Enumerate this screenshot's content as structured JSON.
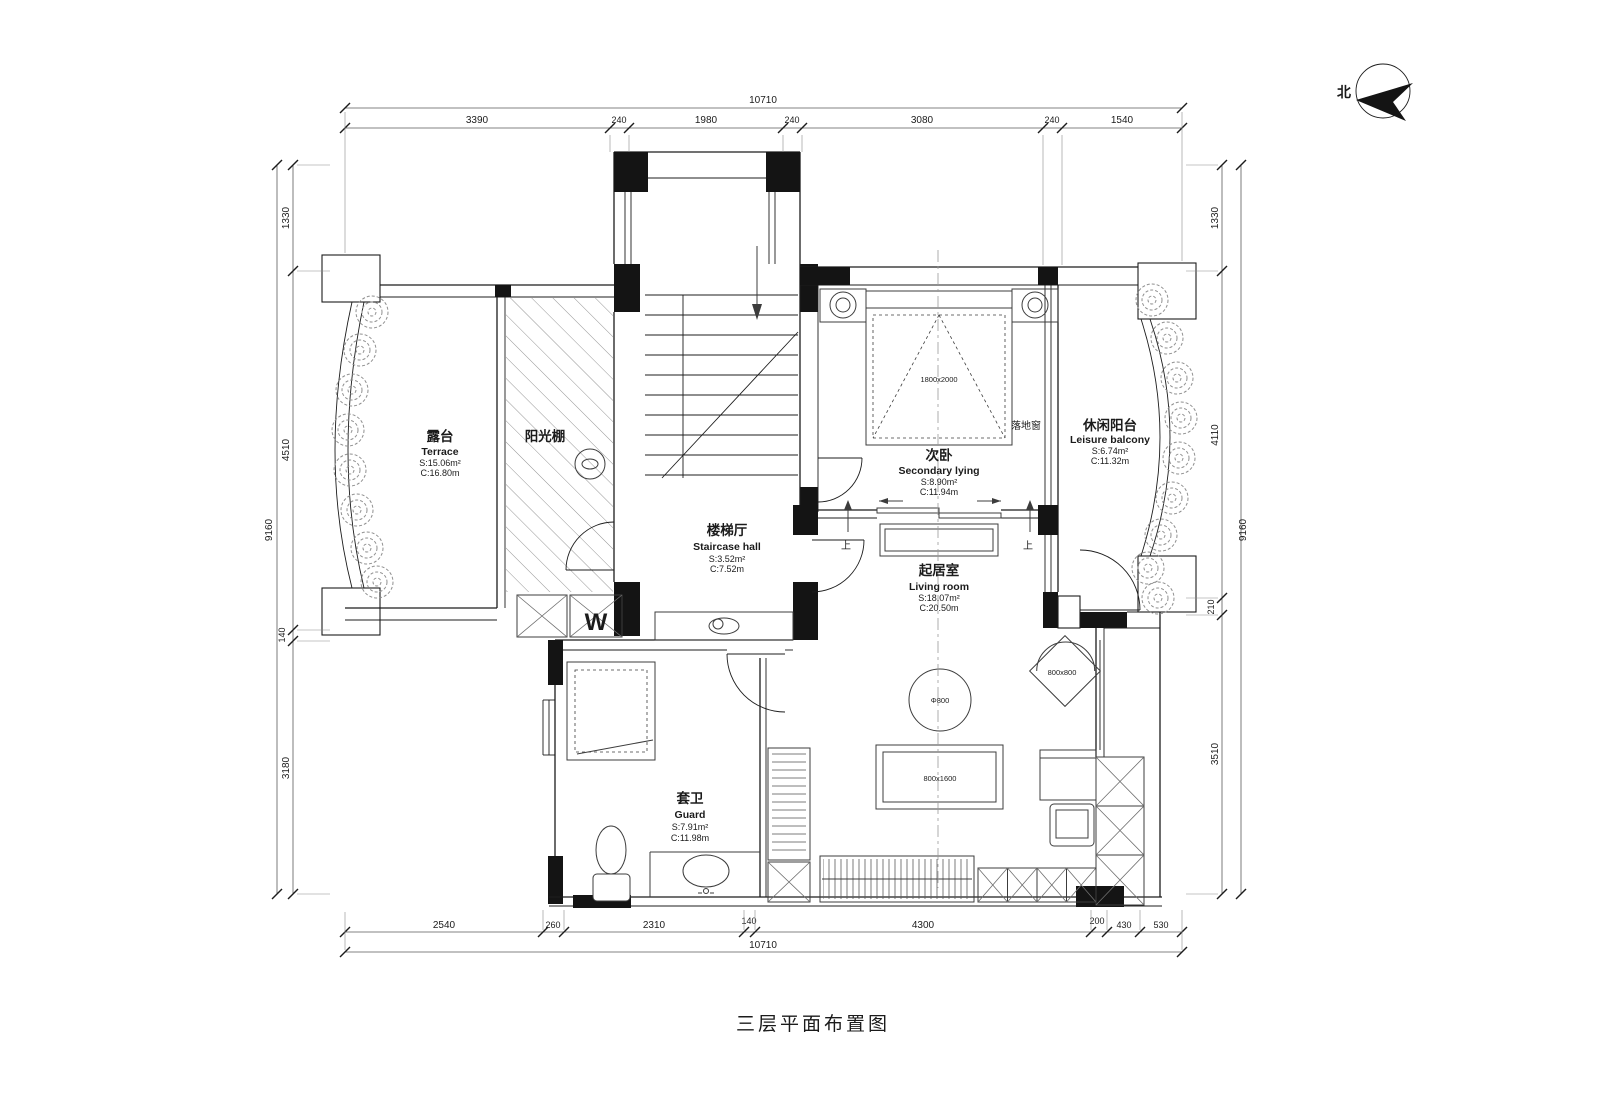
{
  "title": "三层平面布置图",
  "compass": {
    "label": "北"
  },
  "dimensions": {
    "top": {
      "overall": "10710",
      "segments": [
        "3390",
        "240",
        "1980",
        "240",
        "3080",
        "240",
        "1540"
      ]
    },
    "bottom": {
      "overall": "10710",
      "segments": [
        "2540",
        "260",
        "2310",
        "140",
        "4300",
        "200",
        "430",
        "530"
      ]
    },
    "left": {
      "overall": "9160",
      "segments": [
        "1330",
        "4510",
        "140",
        "3180"
      ]
    },
    "right": {
      "overall": "9160",
      "segments": [
        "1330",
        "4110",
        "210",
        "3510"
      ]
    }
  },
  "rooms": {
    "terrace": {
      "zh": "露台",
      "en": "Terrace",
      "area": "S:15.06m²",
      "girth": "C:16.80m"
    },
    "sunroom": {
      "zh": "阳光棚"
    },
    "staircase_hall": {
      "zh": "楼梯厅",
      "en": "Staircase hall",
      "area": "S:3.52m²",
      "girth": "C:7.52m"
    },
    "secondary_bedroom": {
      "zh": "次卧",
      "en": "Secondary lying",
      "area": "S:8.90m²",
      "girth": "C:11.94m"
    },
    "leisure_balcony": {
      "zh": "休闲阳台",
      "en": "Leisure balcony",
      "area": "S:6.74m²",
      "girth": "C:11.32m"
    },
    "living_room": {
      "zh": "起居室",
      "en": "Living room",
      "area": "S:18.07m²",
      "girth": "C:20.50m"
    },
    "guard_bath": {
      "zh": "套卫",
      "en": "Guard",
      "area": "S:7.91m²",
      "girth": "C:11.98m"
    }
  },
  "annotations": {
    "floor_window": "落地窗",
    "up_left": "上",
    "up_right": "上",
    "washer": "W",
    "bed_size": "1800x2000",
    "round_table": "Φ800",
    "coffee_table": "800x1600",
    "corner_chair": "800x800"
  },
  "colors": {
    "line": "#1c1c1c",
    "furniture": "#3c3c3c",
    "green": "#8f8f8f"
  }
}
